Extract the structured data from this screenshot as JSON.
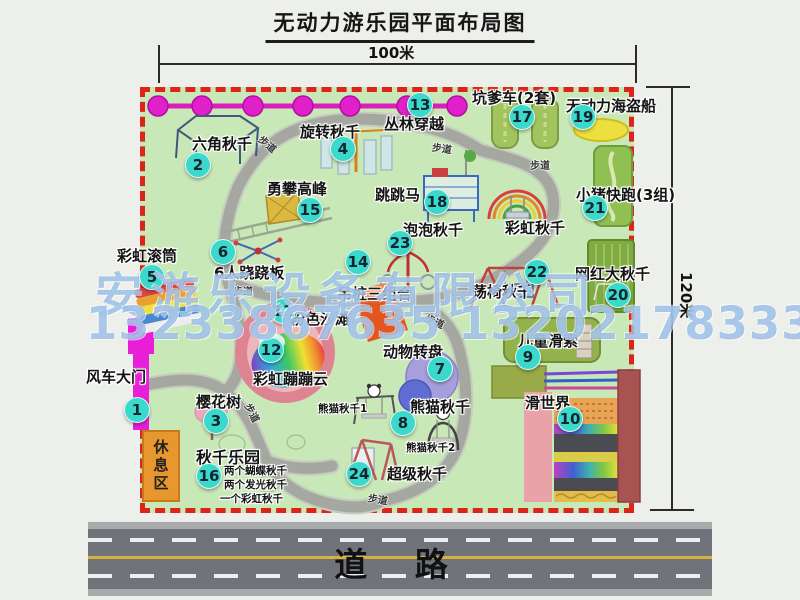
{
  "title": "无动力游乐园平面布局图",
  "dims": {
    "w": "100米",
    "h": "120米"
  },
  "road": {
    "label": "道 路"
  },
  "watermark": {
    "company": "安游乐设备有限公司",
    "phones": "13233867635 13202178333"
  },
  "walkway": {
    "label": "步道"
  },
  "rest": {
    "label": "休息区"
  },
  "rainbow_swing": {
    "label": "彩虹秋千"
  },
  "attractions": [
    {
      "num": "1",
      "label": "风车大门"
    },
    {
      "num": "2",
      "label": "六角秋千"
    },
    {
      "num": "3",
      "label": "樱花树"
    },
    {
      "num": "4",
      "label": "旋转秋千"
    },
    {
      "num": "5",
      "label": "彩虹滚筒"
    },
    {
      "num": "6",
      "label": "6人跷跷板"
    },
    {
      "num": "7",
      "label": "动物转盘"
    },
    {
      "num": "8",
      "label": "熊猫秋千"
    },
    {
      "num": "9",
      "label": "儿童滑索"
    },
    {
      "num": "10",
      "label": "滑世界"
    },
    {
      "num": "11",
      "label": "粉色沙滩"
    },
    {
      "num": "12",
      "label": "彩虹蹦蹦云"
    },
    {
      "num": "13",
      "label": "丛林穿越"
    },
    {
      "num": "14",
      "label": "吊桩三组合"
    },
    {
      "num": "15",
      "label": "勇攀高峰"
    },
    {
      "num": "16",
      "label": "秋千乐园"
    },
    {
      "num": "17",
      "label": "坑爹车(2套)"
    },
    {
      "num": "18",
      "label": "跳跳马"
    },
    {
      "num": "19",
      "label": "无动力海盗船"
    },
    {
      "num": "20",
      "label": "网红大秋千"
    },
    {
      "num": "21",
      "label": "小猪快跑(3组)"
    },
    {
      "num": "22",
      "label": "荡椅秋千"
    },
    {
      "num": "23",
      "label": "泡泡秋千"
    },
    {
      "num": "24",
      "label": "超级秋千"
    }
  ],
  "subs": {
    "panda1": "熊猫秋千1",
    "panda2": "熊猫秋千2",
    "park": [
      "两个蝴蝶秋千",
      "两个发光秋千",
      "一个彩虹秋千"
    ]
  },
  "icons": [
    "jungle-crossing-chain",
    "windmill-gate-icon",
    "hexagon-swing-icon",
    "rotating-swing-icon",
    "climbing-peak-icon",
    "rainbow-roller-icon",
    "seesaw-icon",
    "jump-horse-icon",
    "rainbow-swing-icon",
    "bubble-swing-icon",
    "hanging-post-combo-icon",
    "swing-chair-icon",
    "pink-beach",
    "rainbow-cloud-icon",
    "animal-carousel-icon",
    "panda-swing-icon",
    "super-swing-icon",
    "cherry-tree-icon",
    "pit-cart-icon",
    "pirate-ship-icon",
    "piggy-run-icon",
    "big-swing-icon",
    "kids-zipline-icon",
    "slide-world-icon"
  ],
  "colors": {
    "badge": "#3ad9cb",
    "border": "#dd2418",
    "chain": "#e020c8",
    "park_green": "#c9e8b8",
    "road_gray": "#70747a",
    "watermark_blue": "#649bd7"
  }
}
